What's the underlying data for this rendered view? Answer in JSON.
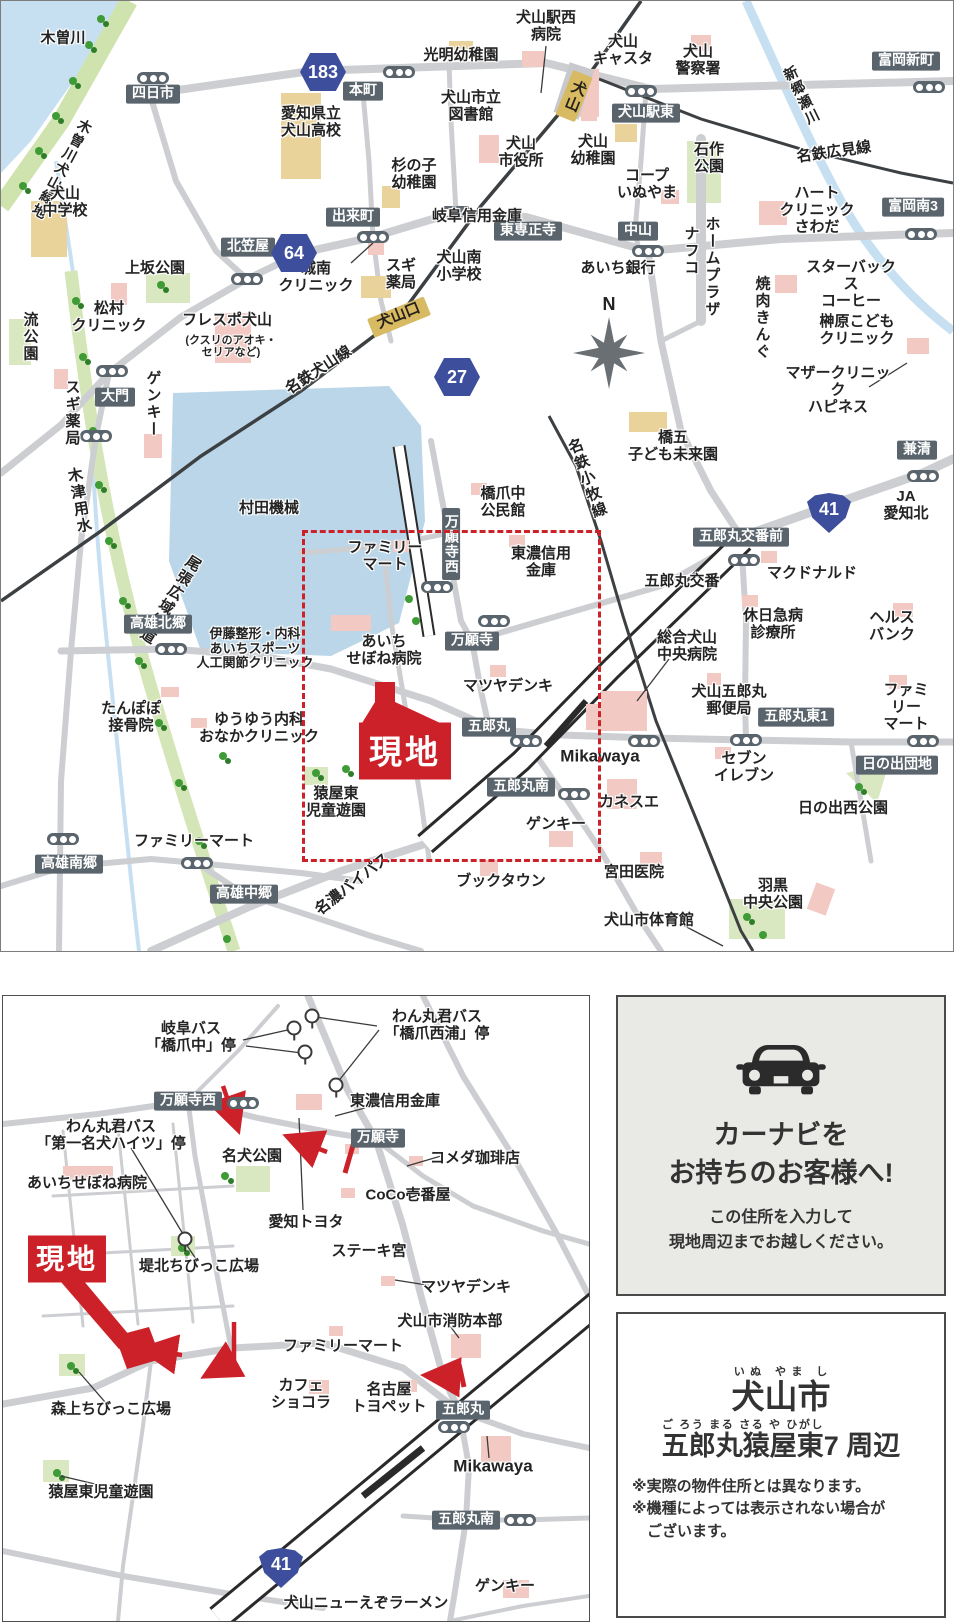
{
  "site_label": "現地",
  "compass_letter": "N",
  "colors": {
    "accent_red": "#cd2129",
    "pill_bg": "#5a646c",
    "badge_blue": "#3d4f9c",
    "station_gold": "#d7ba62",
    "road_gray": "#ccced1",
    "water_blue": "#c6e0f2",
    "factory_blue": "#bad6e8",
    "park_green": "#d9e8c0",
    "building_pink": "#f2c9c3",
    "building_tan": "#ead29b"
  },
  "top_map": {
    "labels": [
      {
        "t": "木曽川",
        "x": 62,
        "y": 38,
        "k": "pl"
      },
      {
        "t": "木曽川犬山緑地",
        "x": 60,
        "y": 168,
        "k": "vpl",
        "r": 28,
        "s": 14
      },
      {
        "t": "犬山\n中学校",
        "x": 64,
        "y": 202,
        "k": "pl"
      },
      {
        "t": "四日市",
        "x": 152,
        "y": 93,
        "k": "pill"
      },
      {
        "t": "本町",
        "x": 362,
        "y": 90,
        "k": "pill"
      },
      {
        "t": "光明幼稚園",
        "x": 460,
        "y": 55,
        "k": "pl"
      },
      {
        "t": "愛知県立\n犬山高校",
        "x": 310,
        "y": 122,
        "k": "pl"
      },
      {
        "t": "犬山市立\n図書館",
        "x": 470,
        "y": 106,
        "k": "pl"
      },
      {
        "t": "犬山駅西\n病院",
        "x": 545,
        "y": 26,
        "k": "pl"
      },
      {
        "t": "犬山\nキャスタ",
        "x": 622,
        "y": 50,
        "k": "pl"
      },
      {
        "t": "犬山\n警察署",
        "x": 697,
        "y": 60,
        "k": "pl"
      },
      {
        "t": "富岡新町",
        "x": 905,
        "y": 60,
        "k": "pill"
      },
      {
        "t": "犬山駅東",
        "x": 645,
        "y": 112,
        "k": "pill"
      },
      {
        "t": "新郷瀬川",
        "x": 800,
        "y": 95,
        "k": "vpl",
        "r": -26,
        "s": 14
      },
      {
        "t": "名鉄広見線",
        "x": 833,
        "y": 152,
        "k": "pl",
        "r": -8
      },
      {
        "t": "富岡南3",
        "x": 912,
        "y": 206,
        "k": "pill"
      },
      {
        "t": "石作\n公園",
        "x": 708,
        "y": 158,
        "k": "pl"
      },
      {
        "t": "コープ\nいぬやま",
        "x": 646,
        "y": 184,
        "k": "pl"
      },
      {
        "t": "犬山\n幼稚園",
        "x": 592,
        "y": 150,
        "k": "pl"
      },
      {
        "t": "犬山\n市役所",
        "x": 520,
        "y": 152,
        "k": "pl"
      },
      {
        "t": "杉の子\n幼稚園",
        "x": 413,
        "y": 174,
        "k": "pl"
      },
      {
        "t": "出来町",
        "x": 352,
        "y": 216,
        "k": "pill"
      },
      {
        "t": "岐阜信用金庫",
        "x": 476,
        "y": 216,
        "k": "pl"
      },
      {
        "t": "ハート\nクリニック\nさわだ",
        "x": 816,
        "y": 210,
        "k": "pl"
      },
      {
        "t": "中山",
        "x": 637,
        "y": 230,
        "k": "pill"
      },
      {
        "t": "東専正寺",
        "x": 527,
        "y": 230,
        "k": "pill"
      },
      {
        "t": "あいち銀行",
        "x": 617,
        "y": 268,
        "k": "pl"
      },
      {
        "t": "ナフコ",
        "x": 689,
        "y": 250,
        "k": "vpl"
      },
      {
        "t": "ホームプラザ",
        "x": 710,
        "y": 266,
        "k": "vpl"
      },
      {
        "t": "スターバックス\nコーヒー",
        "x": 850,
        "y": 284,
        "k": "pl"
      },
      {
        "t": "焼肉きんぐ",
        "x": 760,
        "y": 317,
        "k": "vpl"
      },
      {
        "t": "榊原こども\nクリニック",
        "x": 856,
        "y": 330,
        "k": "pl"
      },
      {
        "t": "マザークリニック\nハピネス",
        "x": 837,
        "y": 390,
        "k": "pl"
      },
      {
        "t": "北笠屋",
        "x": 247,
        "y": 246,
        "k": "pill"
      },
      {
        "t": "城南\nクリニック",
        "x": 315,
        "y": 277,
        "k": "pl"
      },
      {
        "t": "スギ\n薬局",
        "x": 400,
        "y": 274,
        "k": "pl"
      },
      {
        "t": "犬山南\n小学校",
        "x": 458,
        "y": 266,
        "k": "pl"
      },
      {
        "t": "上坂公園",
        "x": 154,
        "y": 268,
        "k": "pl"
      },
      {
        "t": "松村\nクリニック",
        "x": 108,
        "y": 317,
        "k": "pl"
      },
      {
        "t": "フレスポ犬山",
        "x": 226,
        "y": 320,
        "k": "pl"
      },
      {
        "t": "(クスリのアオキ・\nセリアなど)",
        "x": 230,
        "y": 346,
        "k": "pls"
      },
      {
        "t": "流公園",
        "x": 28,
        "y": 336,
        "k": "vpl"
      },
      {
        "t": "大門",
        "x": 114,
        "y": 396,
        "k": "pill"
      },
      {
        "t": "スギ薬局",
        "x": 70,
        "y": 412,
        "k": "vpl"
      },
      {
        "t": "ゲンキー",
        "x": 151,
        "y": 403,
        "k": "vpl"
      },
      {
        "t": "名鉄犬山線",
        "x": 318,
        "y": 370,
        "k": "pl",
        "r": -33
      },
      {
        "t": "木津用水",
        "x": 77,
        "y": 500,
        "k": "vpl",
        "r": -10
      },
      {
        "t": "尾張広域緑道",
        "x": 168,
        "y": 598,
        "k": "vpl",
        "r": 32
      },
      {
        "t": "村田機械",
        "x": 268,
        "y": 508,
        "k": "pl"
      },
      {
        "t": "高雄北郷",
        "x": 157,
        "y": 623,
        "k": "pill"
      },
      {
        "t": "たんぽぽ\n接骨院",
        "x": 130,
        "y": 717,
        "k": "pl"
      },
      {
        "t": "伊藤整形・内科\nあいちスポーツ\n人工関節クリニック",
        "x": 254,
        "y": 648,
        "k": "pl",
        "s": 13
      },
      {
        "t": "ゆうゆう内科\nおなかクリニック",
        "x": 258,
        "y": 728,
        "k": "pl"
      },
      {
        "t": "あいち\nせぼね病院",
        "x": 383,
        "y": 650,
        "k": "pl"
      },
      {
        "t": "ファミリー\nマート",
        "x": 384,
        "y": 556,
        "k": "pl"
      },
      {
        "t": "万願寺西",
        "x": 450,
        "y": 543,
        "k": "vpill"
      },
      {
        "t": "橋爪中\n公民館",
        "x": 502,
        "y": 502,
        "k": "pl"
      },
      {
        "t": "東濃信用\n金庫",
        "x": 540,
        "y": 562,
        "k": "pl"
      },
      {
        "t": "万願寺",
        "x": 471,
        "y": 640,
        "k": "pill"
      },
      {
        "t": "マツヤデンキ",
        "x": 507,
        "y": 686,
        "k": "pl"
      },
      {
        "t": "五郎丸",
        "x": 488,
        "y": 726,
        "k": "pill"
      },
      {
        "t": "猿屋東\n児童遊園",
        "x": 335,
        "y": 802,
        "k": "pl"
      },
      {
        "t": "ファミリーマート",
        "x": 193,
        "y": 841,
        "k": "pl"
      },
      {
        "t": "五郎丸南",
        "x": 520,
        "y": 786,
        "k": "pill"
      },
      {
        "t": "カネスエ",
        "x": 628,
        "y": 802,
        "k": "pl"
      },
      {
        "t": "ゲンキー",
        "x": 555,
        "y": 824,
        "k": "pl"
      },
      {
        "t": "Mikawaya",
        "x": 599,
        "y": 755,
        "k": "pl",
        "s": 17
      },
      {
        "t": "セブン\nイレブン",
        "x": 743,
        "y": 767,
        "k": "pl"
      },
      {
        "t": "名鉄小牧線",
        "x": 585,
        "y": 478,
        "k": "vpl",
        "r": -20
      },
      {
        "t": "橋五\n子ども未来園",
        "x": 672,
        "y": 446,
        "k": "pl"
      },
      {
        "t": "兼清",
        "x": 916,
        "y": 449,
        "k": "pill"
      },
      {
        "t": "JA\n愛知北",
        "x": 905,
        "y": 505,
        "k": "pl"
      },
      {
        "t": "五郎丸交番前",
        "x": 740,
        "y": 536,
        "k": "pill"
      },
      {
        "t": "五郎丸交番",
        "x": 681,
        "y": 581,
        "k": "pl"
      },
      {
        "t": "マクドナルド",
        "x": 811,
        "y": 573,
        "k": "pl"
      },
      {
        "t": "休日急病\n診療所",
        "x": 772,
        "y": 624,
        "k": "pl"
      },
      {
        "t": "ヘルス\nバンク",
        "x": 891,
        "y": 626,
        "k": "pl"
      },
      {
        "t": "総合犬山\n中央病院",
        "x": 686,
        "y": 646,
        "k": "pl"
      },
      {
        "t": "犬山五郎丸\n郵便局",
        "x": 728,
        "y": 700,
        "k": "pl"
      },
      {
        "t": "五郎丸東1",
        "x": 795,
        "y": 716,
        "k": "pill"
      },
      {
        "t": "ファミリー\nマート",
        "x": 905,
        "y": 707,
        "k": "pl"
      },
      {
        "t": "日の出団地",
        "x": 896,
        "y": 764,
        "k": "pill"
      },
      {
        "t": "日の出西公園",
        "x": 842,
        "y": 808,
        "k": "pl"
      },
      {
        "t": "高雄南郷",
        "x": 68,
        "y": 863,
        "k": "pill"
      },
      {
        "t": "高雄中郷",
        "x": 243,
        "y": 893,
        "k": "pill"
      },
      {
        "t": "名濃バイパス",
        "x": 352,
        "y": 884,
        "k": "pl",
        "r": -38
      },
      {
        "t": "ブックタウン",
        "x": 500,
        "y": 881,
        "k": "pl"
      },
      {
        "t": "宮田医院",
        "x": 633,
        "y": 872,
        "k": "pl"
      },
      {
        "t": "羽黒\n中央公園",
        "x": 772,
        "y": 894,
        "k": "pl"
      },
      {
        "t": "犬山市体育館",
        "x": 648,
        "y": 920,
        "k": "pl"
      },
      {
        "t": "犬山",
        "x": 573,
        "y": 95,
        "k": "goldv",
        "r": 22,
        "n": "station-label-inuyama"
      },
      {
        "t": "犬山口",
        "x": 398,
        "y": 316,
        "k": "gold",
        "r": -22,
        "n": "station-label-inuyamaguchi"
      },
      {
        "t": "N",
        "x": 608,
        "y": 303,
        "k": "pl",
        "s": 18,
        "n": "compass-north-label"
      }
    ],
    "badges": [
      {
        "n": "183",
        "x": 322,
        "y": 71,
        "shape": "hex"
      },
      {
        "n": "64",
        "x": 293,
        "y": 252,
        "shape": "hex"
      },
      {
        "n": "27",
        "x": 456,
        "y": 376,
        "shape": "hex"
      },
      {
        "n": "41",
        "x": 828,
        "y": 512,
        "shape": "shield"
      }
    ],
    "signals": [
      [
        152,
        77
      ],
      [
        398,
        71
      ],
      [
        640,
        90
      ],
      [
        928,
        86
      ],
      [
        246,
        278
      ],
      [
        372,
        236
      ],
      [
        455,
        211
      ],
      [
        647,
        250
      ],
      [
        920,
        233
      ],
      [
        111,
        370
      ],
      [
        95,
        435
      ],
      [
        170,
        648
      ],
      [
        62,
        838
      ],
      [
        196,
        862
      ],
      [
        922,
        475
      ],
      [
        743,
        559
      ],
      [
        745,
        739
      ],
      [
        922,
        740
      ],
      [
        643,
        740
      ],
      [
        525,
        740
      ],
      [
        573,
        793
      ],
      [
        493,
        620
      ],
      [
        436,
        586
      ]
    ],
    "bus_stops": []
  },
  "bottom_map": {
    "labels": [
      {
        "t": "岐阜バス\n「橋爪中」停",
        "x": 188,
        "y": 42,
        "k": "pl"
      },
      {
        "t": "わん丸君バス\n「橋爪西浦」停",
        "x": 434,
        "y": 30,
        "k": "pl"
      },
      {
        "t": "万願寺西",
        "x": 185,
        "y": 105,
        "k": "pill"
      },
      {
        "t": "東濃信用金庫",
        "x": 392,
        "y": 106,
        "k": "pl"
      },
      {
        "t": "わん丸君バス\n「第一名犬ハイツ」停",
        "x": 108,
        "y": 140,
        "k": "pl"
      },
      {
        "t": "あいちせぼね病院",
        "x": 84,
        "y": 188,
        "k": "pl"
      },
      {
        "t": "名犬公園",
        "x": 249,
        "y": 161,
        "k": "pl"
      },
      {
        "t": "万願寺",
        "x": 375,
        "y": 142,
        "k": "pill"
      },
      {
        "t": "コメダ珈琲店",
        "x": 472,
        "y": 163,
        "k": "pl"
      },
      {
        "t": "CoCo壱番屋",
        "x": 405,
        "y": 200,
        "k": "pl"
      },
      {
        "t": "愛知トヨタ",
        "x": 303,
        "y": 227,
        "k": "pl"
      },
      {
        "t": "ステーキ宮",
        "x": 366,
        "y": 256,
        "k": "pl"
      },
      {
        "t": "堤北ちびっこ広場",
        "x": 196,
        "y": 271,
        "k": "pl"
      },
      {
        "t": "マツヤデンキ",
        "x": 463,
        "y": 292,
        "k": "pl"
      },
      {
        "t": "犬山市消防本部",
        "x": 447,
        "y": 326,
        "k": "pl"
      },
      {
        "t": "ファミリーマート",
        "x": 340,
        "y": 351,
        "k": "pl"
      },
      {
        "t": "カフェ\nショコラ",
        "x": 298,
        "y": 399,
        "k": "pl"
      },
      {
        "t": "名古屋\nトヨペット",
        "x": 386,
        "y": 403,
        "k": "pl"
      },
      {
        "t": "五郎丸",
        "x": 460,
        "y": 414,
        "k": "pill"
      },
      {
        "t": "Mikawaya",
        "x": 490,
        "y": 470,
        "k": "pl",
        "s": 17
      },
      {
        "t": "森上ちびっこ広場",
        "x": 108,
        "y": 414,
        "k": "pl"
      },
      {
        "t": "猿屋東児童遊園",
        "x": 98,
        "y": 497,
        "k": "pl"
      },
      {
        "t": "五郎丸南",
        "x": 463,
        "y": 524,
        "k": "pill"
      },
      {
        "t": "ゲンキー",
        "x": 502,
        "y": 591,
        "k": "pl"
      },
      {
        "t": "犬山ニューえぞラーメン",
        "x": 363,
        "y": 608,
        "k": "pl"
      }
    ],
    "badges": [
      {
        "n": "41",
        "x": 278,
        "y": 572,
        "shape": "shield"
      }
    ],
    "signals": [
      [
        240,
        107
      ],
      [
        451,
        431
      ],
      [
        517,
        524
      ]
    ],
    "bus_stops": [
      [
        309,
        20
      ],
      [
        291,
        32
      ],
      [
        302,
        56
      ],
      [
        333,
        89
      ],
      [
        182,
        243
      ]
    ]
  },
  "car_panel": {
    "title": "カーナビを\nお持ちのお客様へ!",
    "subtitle": "この住所を入力して\n現地周辺までお越しください。"
  },
  "address_panel": {
    "city": "犬山市",
    "city_kana": "いぬ やま し",
    "area": "五郎丸猿屋東",
    "area_kana": "ご ろう まる さる や ひがし",
    "area_suffix": "7 周辺",
    "notes": "※実際の物件住所とは異なります。\n※機種によっては表示されない場合が\n　ございます。"
  }
}
